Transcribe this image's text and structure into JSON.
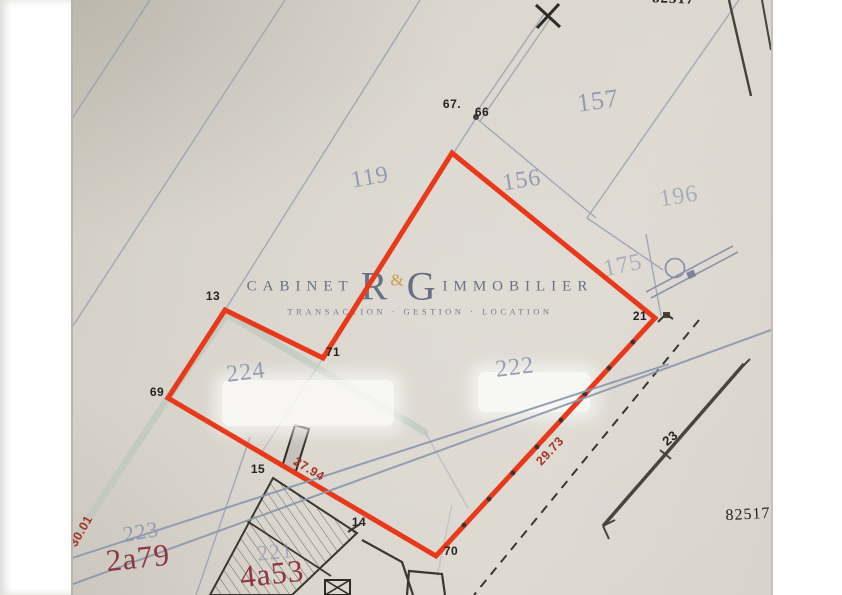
{
  "watermark": {
    "cabinet": "CABINET",
    "initial_r": "R",
    "ampersand": "&",
    "initial_g": "G",
    "immobilier": "IMMOBILIER",
    "tagline": "TRANSACTION · GESTION · LOCATION"
  },
  "parcels": {
    "p119": "119",
    "p157": "157",
    "p156": "156",
    "p196": "196",
    "p175": "175",
    "p224": "224",
    "p222": "222",
    "p223": "223",
    "p221": "221",
    "p151_struck": "151",
    "p154_struck": "154"
  },
  "survey_points": {
    "p67": "67.",
    "p66": "66",
    "p13": "13",
    "p71": "71",
    "p69": "69",
    "p21": "21",
    "p70": "70",
    "p15": "15",
    "p14": "14",
    "p23": "23"
  },
  "measurements": {
    "left_edge": "30.01",
    "bottom_left_edge": "27.94",
    "bottom_right_edge": "29.73"
  },
  "areas": {
    "parcel_223": "2a79",
    "parcel_221": "4a53"
  },
  "plan_numbers": {
    "bottom_right": "82517",
    "top_edge_partial": "82517"
  },
  "colors": {
    "highlight_red": "#e8391b",
    "boundary_blue": "#96a0b4",
    "parcel_label_blue": "#8b96ad",
    "measure_red": "#a93025",
    "area_red": "#8e3742",
    "path_teal": "#bac7bb",
    "paper": "#dbd7cf"
  }
}
